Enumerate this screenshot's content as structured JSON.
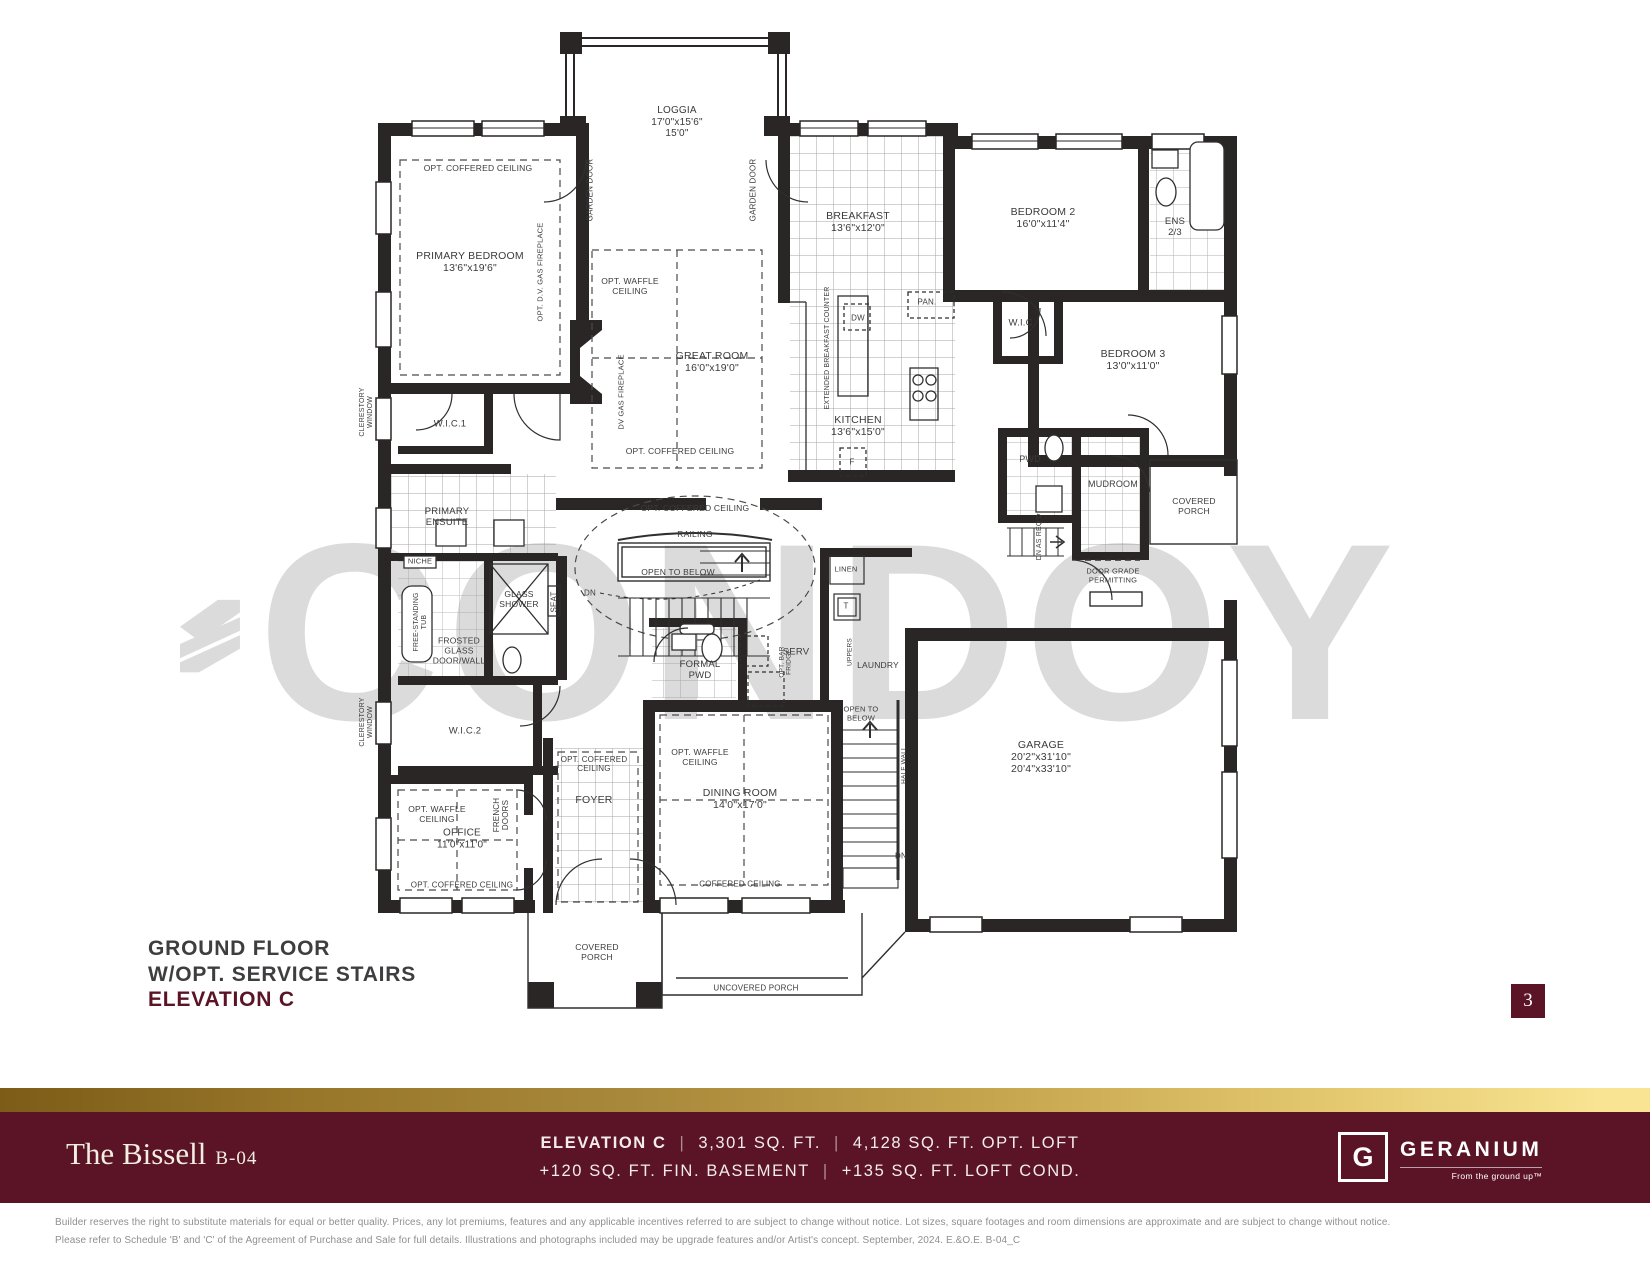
{
  "watermark": {
    "text": "CONDOY"
  },
  "title_block": {
    "line1": "GROUND FLOOR",
    "line2": "W/OPT. SERVICE STAIRS",
    "line3": "ELEVATION C"
  },
  "page_number": "3",
  "footer": {
    "model_name": "The Bissell",
    "model_code": "B-04",
    "divider": "|",
    "line1_part1": "ELEVATION C",
    "line1_part2": "3,301 SQ. FT.",
    "line1_part3": "4,128 SQ. FT. OPT. LOFT",
    "line2_part1": "+120 SQ. FT. FIN. BASEMENT",
    "line2_part2": "+135 SQ. FT. LOFT COND.",
    "brand": {
      "logo_letter": "G",
      "name": "GERANIUM",
      "tagline": "From the ground up™"
    }
  },
  "disclaimer": {
    "line1": "Builder reserves the right to substitute materials for equal or better quality. Prices, any lot premiums, features and any applicable incentives referred to are subject to change without notice. Lot sizes, square footages and room dimensions are approximate and are subject to change without notice.",
    "line2": "Please refer to Schedule 'B' and 'C' of the Agreement of Purchase and Sale for full details. Illustrations and photographs included may be upgrade features and/or Artist's concept. September, 2024. E.&O.E. B-04_C"
  },
  "colors": {
    "maroon": "#5a1426",
    "gold_dark": "#7c5c17",
    "gold_light": "#f8e492",
    "wall": "#2a2626",
    "watermark": "#dbdbdb"
  },
  "plan": {
    "labels": [
      {
        "id": "loggia",
        "t": "LOGGIA\n17'0\"x15'6\"\n15'0\"",
        "x": 677,
        "y": 122,
        "s": 10
      },
      {
        "id": "garden-door-left",
        "t": "GARDEN DOOR",
        "x": 590,
        "y": 190,
        "r": -90,
        "s": 8
      },
      {
        "id": "garden-door-right",
        "t": "GARDEN DOOR",
        "x": 753,
        "y": 190,
        "r": -90,
        "s": 8
      },
      {
        "id": "primary-coffered",
        "t": "OPT. COFFERED CEILING",
        "x": 478,
        "y": 169,
        "s": 8.5
      },
      {
        "id": "primary-bedroom",
        "t": "PRIMARY BEDROOM\n13'6\"x19'6\"",
        "x": 470,
        "y": 262,
        "s": 10.5
      },
      {
        "id": "primary-fireplace",
        "t": "OPT. D.V. GAS FIREPLACE",
        "x": 541,
        "y": 272,
        "r": -90,
        "s": 7.5
      },
      {
        "id": "clerestory-1",
        "t": "CLERESTORY\nWINDOW",
        "x": 367,
        "y": 412,
        "r": -90,
        "s": 7
      },
      {
        "id": "wic1",
        "t": "W.I.C.1",
        "x": 450,
        "y": 425,
        "s": 9.5
      },
      {
        "id": "primary-ensuite",
        "t": "PRIMARY\nENSUITE",
        "x": 447,
        "y": 518,
        "s": 9.5
      },
      {
        "id": "niche",
        "t": "NICHE",
        "x": 420,
        "y": 562,
        "s": 7.5
      },
      {
        "id": "tub",
        "t": "FREE-STANDING\nTUB",
        "x": 421,
        "y": 622,
        "r": -90,
        "s": 7
      },
      {
        "id": "glass-shower",
        "t": "GLASS\nSHOWER",
        "x": 519,
        "y": 600,
        "s": 8.5
      },
      {
        "id": "seat",
        "t": "SEAT",
        "x": 554,
        "y": 602,
        "r": -90,
        "s": 8
      },
      {
        "id": "frosted-glass",
        "t": "FROSTED\nGLASS\nDOOR/WALL",
        "x": 459,
        "y": 651,
        "s": 8.5
      },
      {
        "id": "wic2",
        "t": "W.I.C.2",
        "x": 465,
        "y": 732,
        "s": 9.5
      },
      {
        "id": "clerestory-2",
        "t": "CLERESTORY\nWINDOW",
        "x": 367,
        "y": 722,
        "r": -90,
        "s": 7
      },
      {
        "id": "office-waffle",
        "t": "OPT. WAFFLE\nCEILING",
        "x": 437,
        "y": 815,
        "s": 8.5
      },
      {
        "id": "office",
        "t": "OFFICE\n11'0\"x11'0\"",
        "x": 462,
        "y": 839,
        "s": 10
      },
      {
        "id": "office-coffered",
        "t": "OPT. COFFERED CEILING",
        "x": 462,
        "y": 885,
        "s": 8
      },
      {
        "id": "french-doors",
        "t": "FRENCH\nDOORS",
        "x": 501,
        "y": 815,
        "r": -90,
        "s": 8
      },
      {
        "id": "foyer",
        "t": "FOYER",
        "x": 594,
        "y": 800,
        "s": 10.5
      },
      {
        "id": "foyer-coffered",
        "t": "OPT. COFFERED\nCEILING",
        "x": 594,
        "y": 764,
        "s": 8
      },
      {
        "id": "greatroom-waffle",
        "t": "OPT. WAFFLE\nCEILING",
        "x": 630,
        "y": 287,
        "s": 8.5
      },
      {
        "id": "great-room",
        "t": "GREAT ROOM\n16'0\"x19'0\"",
        "x": 712,
        "y": 362,
        "s": 10.5
      },
      {
        "id": "greatroom-coffered",
        "t": "OPT. COFFERED CEILING",
        "x": 680,
        "y": 452,
        "s": 8.5
      },
      {
        "id": "dv-fireplace",
        "t": "DV GAS FIREPLACE",
        "x": 622,
        "y": 392,
        "r": -90,
        "s": 7.5
      },
      {
        "id": "breakfast",
        "t": "BREAKFAST\n13'6\"x12'0\"",
        "x": 858,
        "y": 222,
        "s": 10.5
      },
      {
        "id": "breakfast-counter",
        "t": "EXTENDED BREAKFAST COUNTER",
        "x": 828,
        "y": 348,
        "r": -90,
        "s": 7
      },
      {
        "id": "dw",
        "t": "DW",
        "x": 858,
        "y": 318,
        "s": 8
      },
      {
        "id": "pan",
        "t": "PAN.",
        "x": 927,
        "y": 302,
        "s": 8
      },
      {
        "id": "kitchen",
        "t": "KITCHEN\n13'6\"x15'0\"",
        "x": 858,
        "y": 426,
        "s": 10.5
      },
      {
        "id": "fridge",
        "t": "F",
        "x": 852,
        "y": 462,
        "s": 8
      },
      {
        "id": "bedroom2",
        "t": "BEDROOM 2\n16'0\"x11'4\"",
        "x": 1043,
        "y": 218,
        "s": 10.5
      },
      {
        "id": "ens",
        "t": "ENS\n2/3",
        "x": 1175,
        "y": 228,
        "s": 9.5
      },
      {
        "id": "wic-bed2",
        "t": "W.I.C.",
        "x": 1022,
        "y": 324,
        "s": 9.5
      },
      {
        "id": "bedroom3",
        "t": "BEDROOM 3\n13'0\"x11'0\"",
        "x": 1133,
        "y": 360,
        "s": 10.5
      },
      {
        "id": "pwd",
        "t": "PWD",
        "x": 1030,
        "y": 459,
        "s": 9
      },
      {
        "id": "mudroom",
        "t": "MUDROOM",
        "x": 1113,
        "y": 484,
        "s": 9
      },
      {
        "id": "dn-as-reqd",
        "t": "DN AS REQ'D",
        "x": 1040,
        "y": 537,
        "r": -90,
        "s": 7
      },
      {
        "id": "covered-porch-right",
        "t": "COVERED\nPORCH",
        "x": 1194,
        "y": 507,
        "s": 8.5
      },
      {
        "id": "door-grade",
        "t": "DOOR GRADE\nPERMITTING",
        "x": 1113,
        "y": 576,
        "s": 7.5
      },
      {
        "id": "center-coffered",
        "t": "OPT. COFFERED CEILING",
        "x": 695,
        "y": 509,
        "s": 8.5
      },
      {
        "id": "railing",
        "t": "RAILING",
        "x": 695,
        "y": 535,
        "s": 8.5
      },
      {
        "id": "open-below-main",
        "t": "OPEN TO BELOW",
        "x": 678,
        "y": 573,
        "s": 8.5
      },
      {
        "id": "dn-main",
        "t": "DN",
        "x": 590,
        "y": 593,
        "s": 8
      },
      {
        "id": "linen",
        "t": "LINEN",
        "x": 846,
        "y": 570,
        "s": 7.5
      },
      {
        "id": "t-closet",
        "t": "T",
        "x": 846,
        "y": 606,
        "s": 8
      },
      {
        "id": "serv",
        "t": "SERV",
        "x": 796,
        "y": 653,
        "s": 9.5
      },
      {
        "id": "bar-fridge",
        "t": "OPT. BAR\nFRIDGE",
        "x": 786,
        "y": 662,
        "r": -90,
        "s": 6.5
      },
      {
        "id": "uppers",
        "t": "UPPERS",
        "x": 850,
        "y": 652,
        "r": -90,
        "s": 6.5
      },
      {
        "id": "laundry",
        "t": "LAUNDRY",
        "x": 878,
        "y": 666,
        "s": 8.5
      },
      {
        "id": "formal-pwd",
        "t": "FORMAL\nPWD",
        "x": 700,
        "y": 671,
        "s": 9.5
      },
      {
        "id": "open-below-serv",
        "t": "OPEN TO\nBELOW",
        "x": 861,
        "y": 714,
        "s": 7.5
      },
      {
        "id": "dn-serv",
        "t": "DN",
        "x": 901,
        "y": 856,
        "s": 8
      },
      {
        "id": "half-wall",
        "t": "HALF WALL",
        "x": 904,
        "y": 765,
        "r": -90,
        "s": 6.5
      },
      {
        "id": "garage",
        "t": "GARAGE\n20'2\"x31'10\"\n20'4\"x33'10\"",
        "x": 1041,
        "y": 757,
        "s": 10.5
      },
      {
        "id": "dining-waffle",
        "t": "OPT. WAFFLE\nCEILING",
        "x": 700,
        "y": 758,
        "s": 8.5
      },
      {
        "id": "dining-room",
        "t": "DINING ROOM\n14'0\"x17'0\"",
        "x": 740,
        "y": 799,
        "s": 10.5
      },
      {
        "id": "dining-coffered",
        "t": "COFFERED CEILING",
        "x": 740,
        "y": 884,
        "s": 8
      },
      {
        "id": "covered-porch-bottom",
        "t": "COVERED\nPORCH",
        "x": 597,
        "y": 953,
        "s": 8.5
      },
      {
        "id": "uncovered-porch",
        "t": "UNCOVERED PORCH",
        "x": 756,
        "y": 988,
        "s": 8
      }
    ]
  }
}
